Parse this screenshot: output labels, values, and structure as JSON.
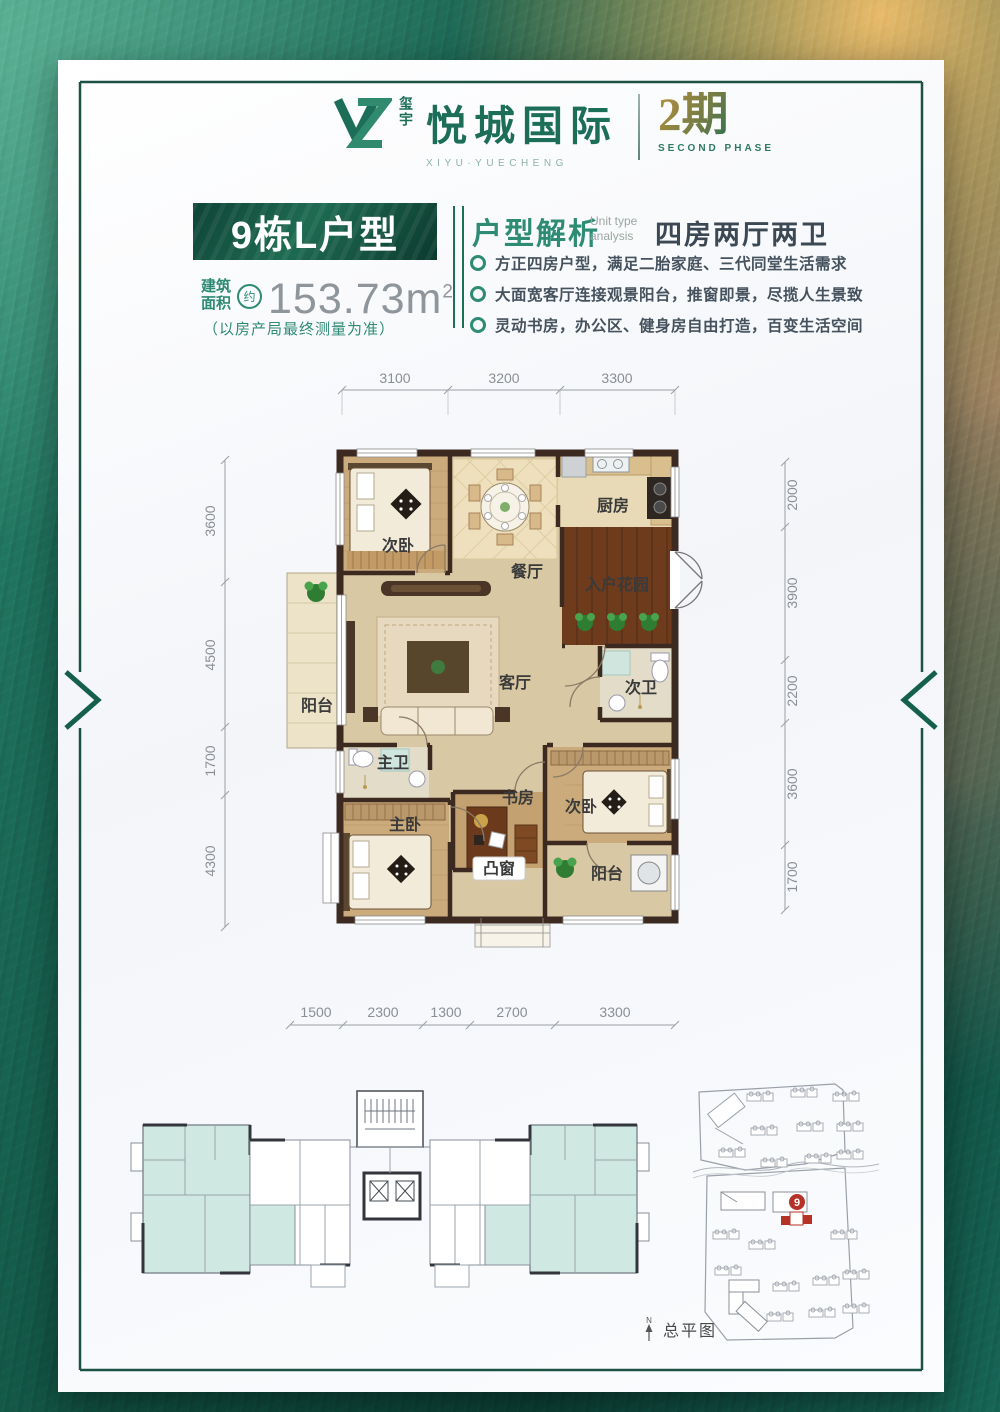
{
  "colors": {
    "accent_green": "#1e6e58",
    "light_green": "#2e8b74",
    "title_block": "#0f4336",
    "gold": "#c9a24a",
    "red_highlight": "#b63127",
    "teal_unit_fill": "#cfe9e2"
  },
  "logo": {
    "brand_vertical": "玺宇",
    "brand_name": "悦城国际",
    "brand_sub": "XIYU·YUECHENG",
    "phase": "2期",
    "phase_sub": "SECOND PHASE"
  },
  "header": {
    "unit_title": "9栋L户型",
    "area_prefix_line1": "建筑",
    "area_prefix_line2": "面积",
    "area_approx": "约",
    "area_value": "153.73m",
    "area_sup": "2",
    "area_note": "（以房产局最终测量为准）"
  },
  "analysis": {
    "title": "户型解析",
    "subtitle_en_line1": "Unit type",
    "subtitle_en_line2": "analysis",
    "layout_summary": "四房两厅两卫",
    "bullets": [
      "方正四房户型，满足二胎家庭、三代同堂生活需求",
      "大面宽客厅连接观景阳台，推窗即景，尽揽人生景致",
      "灵动书房，办公区、健身房自由打造，百变生活空间"
    ]
  },
  "floorplan": {
    "rooms": [
      {
        "name": "bedroom-2-top",
        "label": "次卧"
      },
      {
        "name": "dining-room",
        "label": "餐厅"
      },
      {
        "name": "kitchen",
        "label": "厨房"
      },
      {
        "name": "entry-garden",
        "label": "入户花园"
      },
      {
        "name": "living-room",
        "label": "客厅"
      },
      {
        "name": "bath-2",
        "label": "次卫"
      },
      {
        "name": "balcony-left",
        "label": "阳台"
      },
      {
        "name": "master-bath",
        "label": "主卫"
      },
      {
        "name": "master-bedroom",
        "label": "主卧"
      },
      {
        "name": "study",
        "label": "书房"
      },
      {
        "name": "bedroom-2-bottom",
        "label": "次卧"
      },
      {
        "name": "bay-window",
        "label": "凸窗"
      },
      {
        "name": "balcony-bottom",
        "label": "阳台"
      }
    ],
    "dims_top": [
      "3100",
      "3200",
      "3300"
    ],
    "dims_left": [
      "3600",
      "4500",
      "1700",
      "4300"
    ],
    "dims_right": [
      "2000",
      "3900",
      "2200",
      "3600",
      "1700"
    ],
    "dims_bottom": [
      "1500",
      "2300",
      "1300",
      "2700",
      "3300"
    ]
  },
  "siteplan": {
    "label": "总平图",
    "north_label": "N",
    "building_badge": "9"
  }
}
